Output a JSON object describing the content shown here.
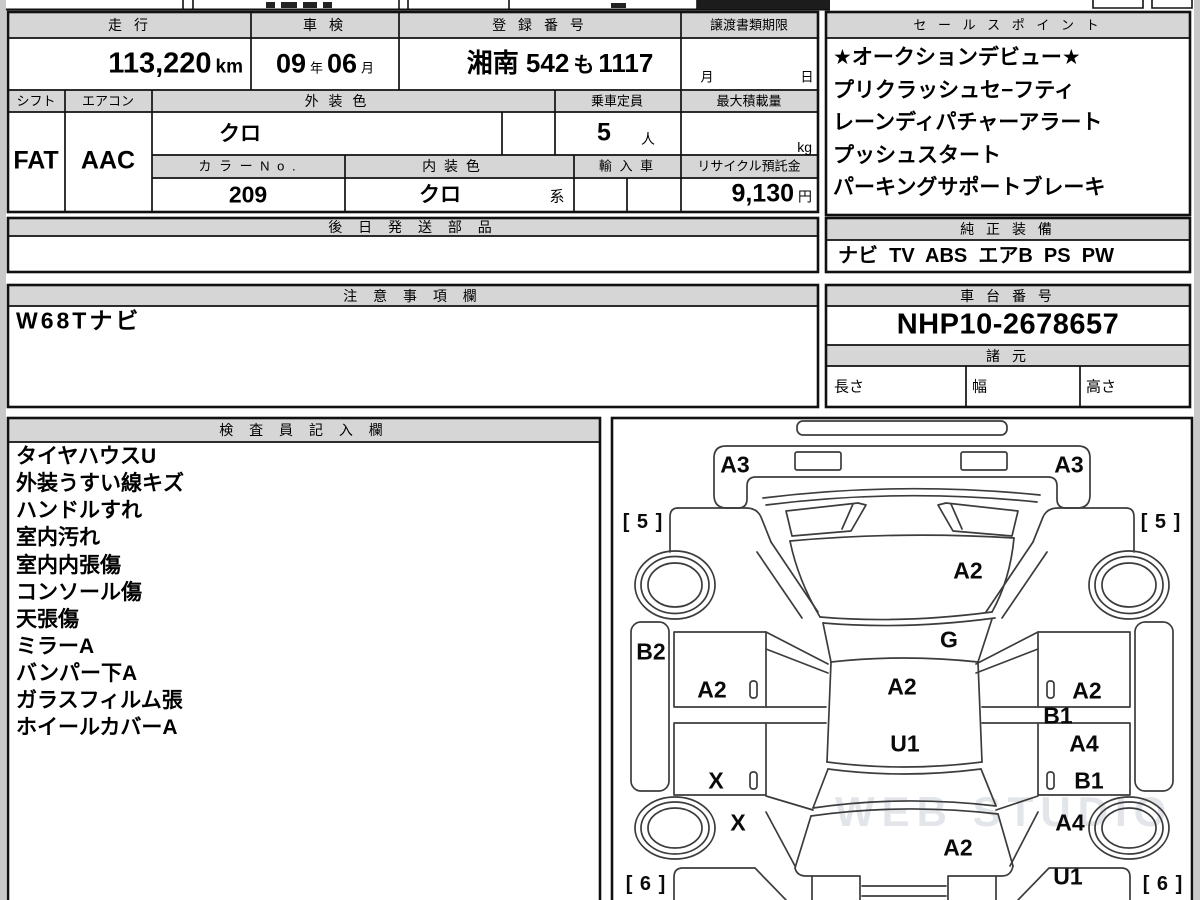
{
  "page": {
    "watermark": "WEB STUDIO R10"
  },
  "table": {
    "mileage_label": "走 行",
    "mileage_value": "113,220",
    "mileage_unit": "km",
    "inspection_label": "車 検",
    "inspection_year": "09",
    "inspection_year_unit": "年",
    "inspection_month": "06",
    "inspection_month_unit": "月",
    "registration_label": "登 録 番 号",
    "registration_area": "湘南 542",
    "registration_kana": "も",
    "registration_number": "1117",
    "transfer_label": "譲渡書類期限",
    "transfer_month": "月",
    "transfer_day": "日",
    "shift_label": "シフト",
    "shift_value": "FAT",
    "aircon_label": "エアコン",
    "aircon_value": "AAC",
    "exterior_label": "外 装 色",
    "exterior_value": "クロ",
    "capacity_label": "乗車定員",
    "capacity_value": "5",
    "capacity_unit": "人",
    "maxload_label": "最大積載量",
    "maxload_unit": "kg",
    "colorno_label": "カ ラ ー N o .",
    "colorno_value": "209",
    "interior_label": "内 装 色",
    "interior_value": "クロ",
    "interior_suffix": "系",
    "import_label": "輸 入 車",
    "recycle_label": "リサイクル預託金",
    "recycle_value": "9,130",
    "recycle_unit": "円",
    "later_label": "後 日 発 送 部 品"
  },
  "notes": {
    "label": "注 意 事 項 欄",
    "value": "W68Tナビ"
  },
  "sales": {
    "label": "セ ー ル ス ポ イ ン ト",
    "items": [
      "★オークションデビュー★",
      "プリクラッシュセ−フティ",
      "レーンディパチャーアラート",
      "プッシュスタート",
      "パーキングサポートブレーキ"
    ]
  },
  "equipment": {
    "label": "純 正 装 備",
    "value": "ナビ  TV  ABS  エアB  PS  PW"
  },
  "chassis": {
    "label": "車 台 番 号",
    "value": "NHP10-2678657"
  },
  "specs": {
    "label": "諸 元",
    "length": "長さ",
    "width": "幅",
    "height": "高さ"
  },
  "inspector": {
    "label": "検 査 員 記 入 欄",
    "items": [
      "タイヤハウスU",
      "外装うすい線キズ",
      "ハンドルすれ",
      "室内汚れ",
      "室内内張傷",
      "コンソール傷",
      "天張傷",
      "ミラーA",
      "バンパー下A",
      "ガラスフィルム張",
      "ホイールカバーA"
    ]
  },
  "diagram": {
    "labels": [
      {
        "text": "A3",
        "x": 735,
        "y": 465
      },
      {
        "text": "A3",
        "x": 1069,
        "y": 465
      },
      {
        "text": "[ 5 ]",
        "x": 643,
        "y": 522
      },
      {
        "text": "[ 5 ]",
        "x": 1161,
        "y": 522
      },
      {
        "text": "A2",
        "x": 968,
        "y": 571
      },
      {
        "text": "G",
        "x": 949,
        "y": 640
      },
      {
        "text": "B2",
        "x": 651,
        "y": 652
      },
      {
        "text": "A2",
        "x": 712,
        "y": 690
      },
      {
        "text": "A2",
        "x": 902,
        "y": 687
      },
      {
        "text": "A2",
        "x": 1087,
        "y": 691
      },
      {
        "text": "B1",
        "x": 1058,
        "y": 716
      },
      {
        "text": "U1",
        "x": 905,
        "y": 744
      },
      {
        "text": "A4",
        "x": 1084,
        "y": 744
      },
      {
        "text": "X",
        "x": 716,
        "y": 781
      },
      {
        "text": "B1",
        "x": 1089,
        "y": 781
      },
      {
        "text": "X",
        "x": 738,
        "y": 823
      },
      {
        "text": "A4",
        "x": 1070,
        "y": 823
      },
      {
        "text": "A2",
        "x": 958,
        "y": 848
      },
      {
        "text": "U1",
        "x": 1068,
        "y": 877
      },
      {
        "text": "[ 6 ]",
        "x": 646,
        "y": 884
      },
      {
        "text": "[ 6 ]",
        "x": 1163,
        "y": 884
      }
    ]
  }
}
